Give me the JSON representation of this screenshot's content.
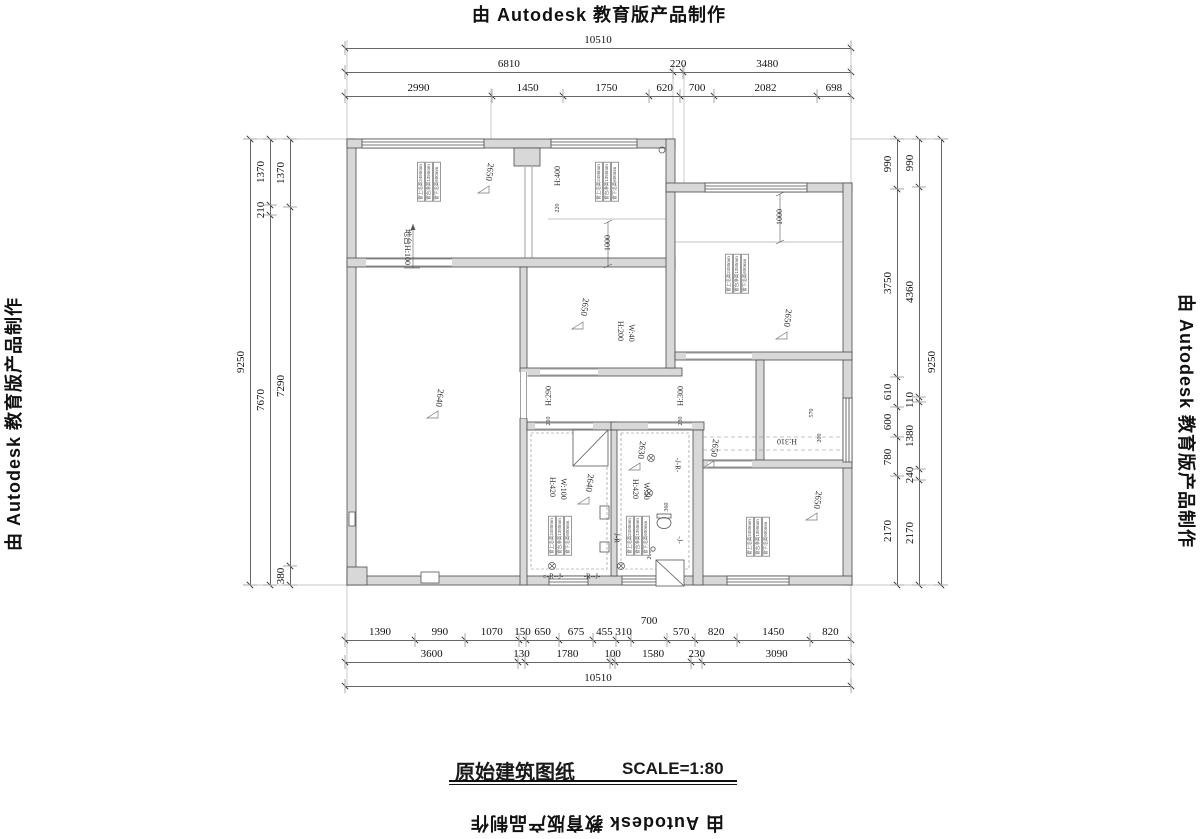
{
  "watermarks": {
    "top": "由 Autodesk 教育版产品制作",
    "bottom": "由 Autodesk 教育版产品制作",
    "left": "由 Autodesk 教育版产品制作",
    "right": "由 Autodesk 教育版产品制作"
  },
  "title_block": {
    "title": "原始建筑图纸",
    "scale": "SCALE=1:80"
  },
  "colors": {
    "line": "#4a4a4a",
    "wall_fill": "#d8d8d8",
    "dim_text": "#111111"
  },
  "dim_chains": [
    {
      "o": "h",
      "x0": 345,
      "x1": 851,
      "y": 48,
      "segs": [
        "10510"
      ]
    },
    {
      "o": "h",
      "x0": 345,
      "x1": 851,
      "y": 72,
      "segs": [
        "6810",
        "220",
        "3480"
      ]
    },
    {
      "o": "h",
      "x0": 345,
      "x1": 851,
      "y": 96,
      "segs": [
        "2990",
        "1450",
        "1750",
        "620",
        "700",
        "2082",
        "698"
      ]
    },
    {
      "o": "h",
      "x0": 345,
      "x1": 851,
      "y": 640,
      "segs": [
        "1390",
        "990",
        "1070",
        "150",
        "650",
        "675",
        "455",
        "310",
        {
          "v": "700",
          "dy": -11
        },
        "570",
        "820",
        "1450",
        "820"
      ]
    },
    {
      "o": "h",
      "x0": 345,
      "x1": 851,
      "y": 662,
      "segs": [
        "3600",
        "130",
        "1780",
        "100",
        "1580",
        "230",
        "3090"
      ]
    },
    {
      "o": "h",
      "x0": 345,
      "x1": 851,
      "y": 686,
      "segs": [
        "10510"
      ]
    },
    {
      "o": "v",
      "x": 250,
      "y0": 139,
      "y1": 585,
      "segs": [
        "9250"
      ]
    },
    {
      "o": "v",
      "x": 270,
      "y0": 139,
      "y1": 585,
      "segs": [
        "1370",
        "210",
        "7670"
      ]
    },
    {
      "o": "v",
      "x": 290,
      "y0": 139,
      "y1": 585,
      "segs": [
        "1370",
        "7290",
        "380"
      ]
    },
    {
      "o": "v",
      "x": 897,
      "y0": 139,
      "y1": 585,
      "segs": [
        "990",
        "3750",
        "610",
        "600",
        "780",
        "2170"
      ]
    },
    {
      "o": "v",
      "x": 919,
      "y0": 139,
      "y1": 585,
      "segs": [
        "990",
        "4360",
        "110",
        "1380",
        "240",
        "2170"
      ]
    },
    {
      "o": "v",
      "x": 941,
      "y0": 139,
      "y1": 585,
      "segs": [
        "9250"
      ]
    }
  ],
  "interior_labels": [
    {
      "t": "H:400",
      "x": 558,
      "y": 176,
      "r": -90,
      "fs": 8
    },
    {
      "t": "220",
      "x": 558,
      "y": 208,
      "r": -90,
      "fs": 6
    },
    {
      "t": "1000",
      "x": 608,
      "y": 243,
      "r": -90,
      "fs": 8
    },
    {
      "t": "1000",
      "x": 780,
      "y": 217,
      "r": -90,
      "fs": 8
    },
    {
      "t": "H:290",
      "x": 549,
      "y": 396,
      "r": -90,
      "fs": 8
    },
    {
      "t": "210",
      "x": 549,
      "y": 421,
      "r": -90,
      "fs": 6
    },
    {
      "t": "H:300",
      "x": 681,
      "y": 396,
      "r": -90,
      "fs": 8
    },
    {
      "t": "230",
      "x": 681,
      "y": 421,
      "r": -90,
      "fs": 6
    },
    {
      "t": "H:200",
      "x": 620,
      "y": 331,
      "r": 90,
      "fs": 8
    },
    {
      "t": "W:40",
      "x": 631,
      "y": 333,
      "r": 90,
      "fs": 8
    },
    {
      "t": "H:420",
      "x": 552,
      "y": 487,
      "r": 90,
      "fs": 8
    },
    {
      "t": "W:100",
      "x": 563,
      "y": 489,
      "r": 90,
      "fs": 8
    },
    {
      "t": "H:420",
      "x": 635,
      "y": 489,
      "r": 90,
      "fs": 8
    },
    {
      "t": "W:50",
      "x": 646,
      "y": 491,
      "r": 90,
      "fs": 8
    },
    {
      "t": "360",
      "x": 667,
      "y": 507,
      "r": -90,
      "fs": 6
    },
    {
      "t": "200",
      "x": 650,
      "y": 555,
      "r": -90,
      "fs": 6
    },
    {
      "t": "570",
      "x": 812,
      "y": 413,
      "r": -90,
      "fs": 6
    },
    {
      "t": "200",
      "x": 820,
      "y": 438,
      "r": -90,
      "fs": 6
    },
    {
      "t": "H:310",
      "x": 787,
      "y": 441,
      "r": 180,
      "fs": 8
    },
    {
      "t": "地台H:100",
      "x": 407,
      "y": 247,
      "r": 90,
      "fs": 8
    },
    {
      "t": "-J-R-",
      "x": 677,
      "y": 465,
      "r": 90,
      "fs": 7
    },
    {
      "t": "-J-",
      "x": 679,
      "y": 540,
      "r": 90,
      "fs": 7
    },
    {
      "t": "J-R",
      "x": 616,
      "y": 538,
      "r": 90,
      "fs": 7
    },
    {
      "t": "○-R--J-",
      "x": 553,
      "y": 577,
      "r": 0,
      "fs": 7
    },
    {
      "t": "-R--J-",
      "x": 592,
      "y": 577,
      "r": 0,
      "fs": 7
    }
  ],
  "ceiling_labels": [
    {
      "v": "2650",
      "x": 490,
      "y": 172
    },
    {
      "v": "2650",
      "x": 585,
      "y": 307
    },
    {
      "v": "2650",
      "x": 788,
      "y": 318
    },
    {
      "v": "2640",
      "x": 440,
      "y": 398
    },
    {
      "v": "2640",
      "x": 590,
      "y": 483
    },
    {
      "v": "2630",
      "x": 642,
      "y": 450
    },
    {
      "v": "2650",
      "x": 715,
      "y": 448
    },
    {
      "v": "2650",
      "x": 818,
      "y": 500
    }
  ],
  "window_notes": {
    "lines": [
      "窗上沿高2450mm",
      "窗台净高1350mm",
      "窗下沿高600mm"
    ],
    "positions": [
      {
        "x": 429,
        "y": 182
      },
      {
        "x": 607,
        "y": 182
      },
      {
        "x": 737,
        "y": 274
      },
      {
        "x": 560,
        "y": 536
      },
      {
        "x": 638,
        "y": 536
      },
      {
        "x": 758,
        "y": 537
      }
    ]
  }
}
